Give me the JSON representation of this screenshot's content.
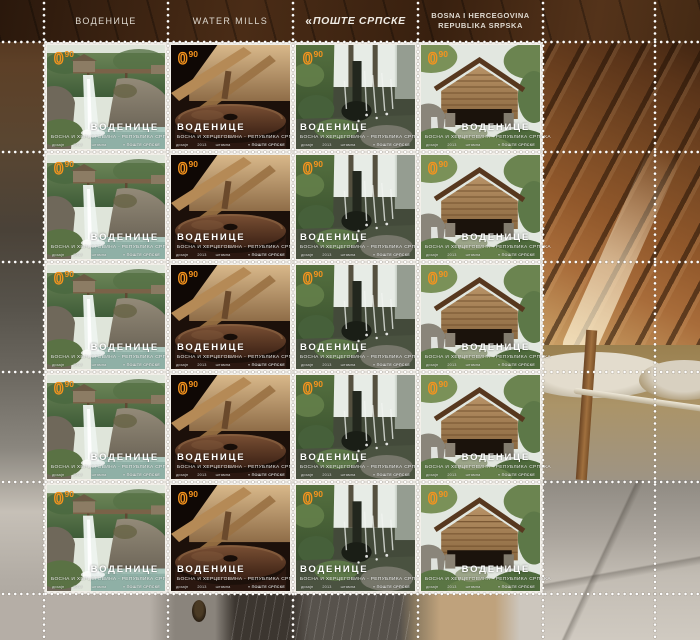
{
  "sheet": {
    "title": "Воденице / Water Mills stamp sheet",
    "grid": {
      "rows": 5,
      "columns": 4
    },
    "header": {
      "col1": "ВОДЕНИЦЕ",
      "col2": "WATER MILLS",
      "col3_mark": "«",
      "col3": "ПОШТЕ СРПСКЕ",
      "col4_line1": "BOSNA I HERCEGOVINA",
      "col4_line2": "REPUBLIKA SRPSKA"
    }
  },
  "stamp_common": {
    "denomination_int": "0",
    "denomination_sup": "90",
    "title": "ВОДЕНИЦЕ",
    "country": "БОСНА И ХЕРЦЕГОВИНА - РЕПУБЛИКА СРПСКА",
    "imprint_1": "дизајн",
    "imprint_2": "2013",
    "imprint_3": "штампа",
    "publisher": "« ПОШТЕ СРПСКЕ"
  },
  "stamp_designs": [
    "waterfall-and-wooden-flume-mill",
    "millstone-interior",
    "waterwheel-with-splashing-water",
    "wooden-mill-hut"
  ],
  "colors": {
    "denomination_orange": "#F7941D",
    "perforation_dot": "#FFFFFF",
    "stamp_paper": "#F2EFE9",
    "selvage_wood": "#4A2C16"
  }
}
